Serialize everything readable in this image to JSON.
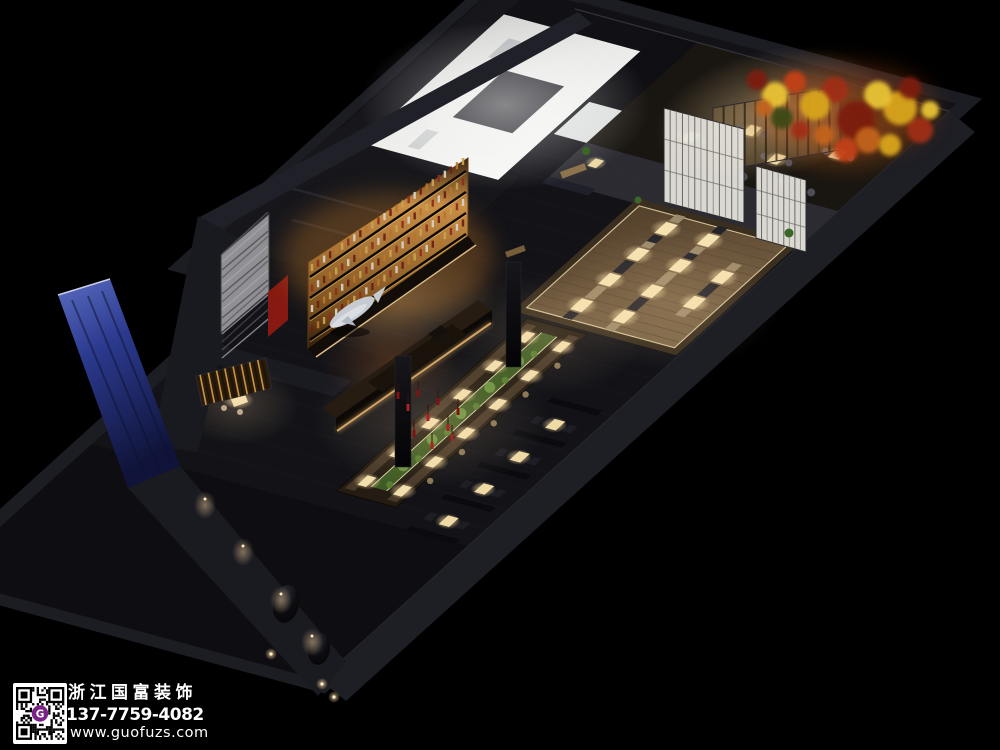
{
  "watermark": {
    "company_name": "浙江国富装饰",
    "phone": "137-7759-4082",
    "website": "www.guofuzs.com",
    "qr_monogram": "G"
  },
  "palette": {
    "background": "#000000",
    "watermark_text": "#ffffff",
    "qr_accent_purple": "#7b2286",
    "kitchen_white": "#ededeb",
    "wine_wall_amber": "#d79a44",
    "table_light_warm": "#f5e3b2",
    "wood_floor": "#6e583e",
    "planter_green": "#4f7a2e",
    "foliage_red": "#a02d14",
    "foliage_yellow": "#d9a51e",
    "entry_wall_blue": "#2b3a8e",
    "accent_red_wall": "#8e1a12",
    "structure_dark": "#1c1c23"
  }
}
